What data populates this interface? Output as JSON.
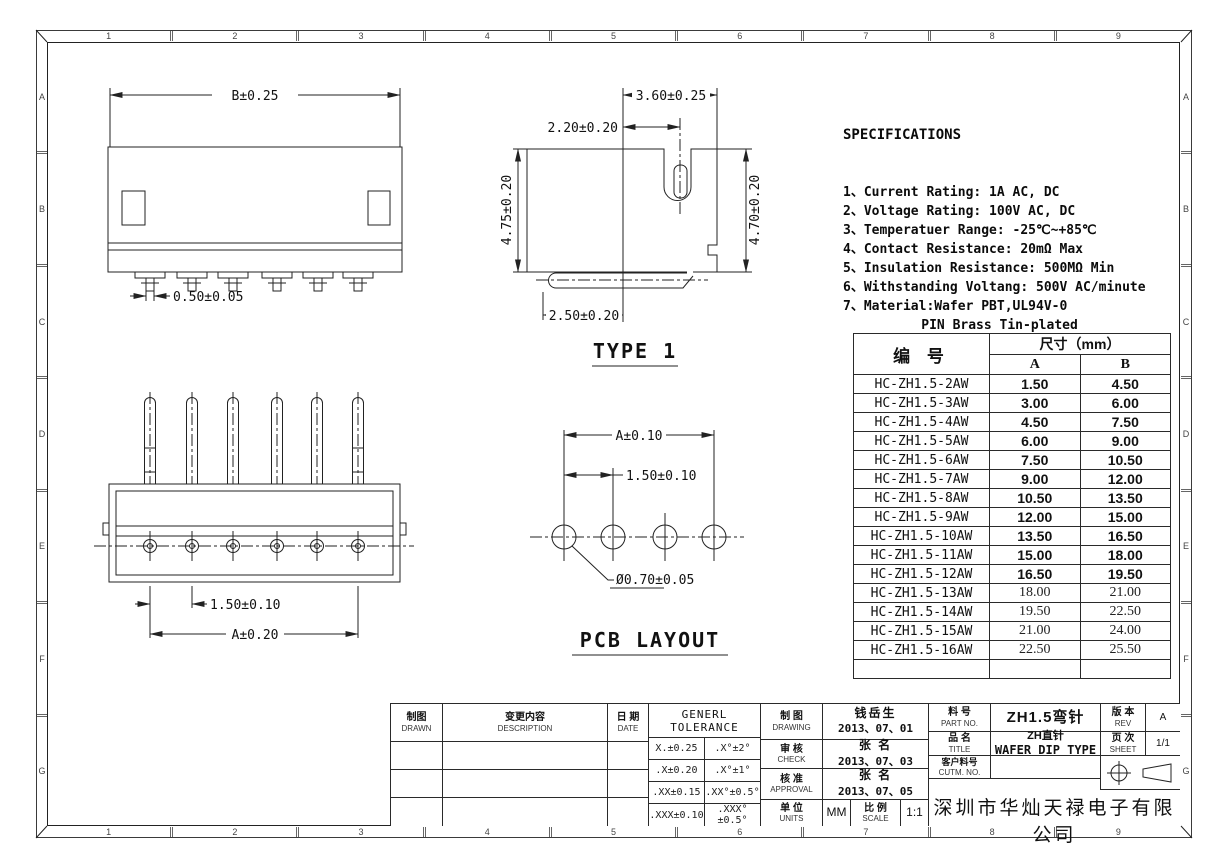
{
  "frame": {
    "columns": [
      "1",
      "2",
      "3",
      "4",
      "5",
      "6",
      "7",
      "8",
      "9"
    ],
    "rows": [
      "A",
      "B",
      "C",
      "D",
      "E",
      "F",
      "G"
    ]
  },
  "specs": {
    "title": "SPECIFICATIONS",
    "lines": [
      "1、Current Rating: 1A AC, DC",
      "2、Voltage Rating: 100V AC, DC",
      "3、Temperatuer Range: -25℃~+85℃",
      "4、Contact Resistance: 20mΩ Max",
      "5、Insulation Resistance: 500MΩ Min",
      "6、Withstanding Voltang: 500V AC/minute",
      "7、Material:Wafer PBT,UL94V-0",
      "          PIN Brass Tin-plated"
    ]
  },
  "views": {
    "side": {
      "dim_b": "B±0.25",
      "dim_pin": "0.50±0.05"
    },
    "type1": {
      "label": "TYPE 1",
      "dim_top": "3.60±0.25",
      "dim_slot": "2.20±0.20",
      "dim_left": "4.75±0.20",
      "dim_right": "4.70±0.20",
      "dim_bottom": "2.50±0.20"
    },
    "front": {
      "dim_pitch": "1.50±0.10",
      "dim_width": "A±0.20"
    },
    "pcb": {
      "label": "PCB LAYOUT",
      "dim_width": "A±0.10",
      "dim_pitch": "1.50±0.10",
      "dim_hole": "Ø0.70±0.05"
    }
  },
  "parts_table": {
    "col_part": "编  号",
    "col_dim": "尺寸（mm）",
    "col_a": "A",
    "col_b": "B",
    "rows": [
      {
        "part": "HC-ZH1.5-2AW",
        "a": "1.50",
        "b": "4.50",
        "bold": true
      },
      {
        "part": "HC-ZH1.5-3AW",
        "a": "3.00",
        "b": "6.00",
        "bold": true
      },
      {
        "part": "HC-ZH1.5-4AW",
        "a": "4.50",
        "b": "7.50",
        "bold": true
      },
      {
        "part": "HC-ZH1.5-5AW",
        "a": "6.00",
        "b": "9.00",
        "bold": true
      },
      {
        "part": "HC-ZH1.5-6AW",
        "a": "7.50",
        "b": "10.50",
        "bold": true
      },
      {
        "part": "HC-ZH1.5-7AW",
        "a": "9.00",
        "b": "12.00",
        "bold": true
      },
      {
        "part": "HC-ZH1.5-8AW",
        "a": "10.50",
        "b": "13.50",
        "bold": true
      },
      {
        "part": "HC-ZH1.5-9AW",
        "a": "12.00",
        "b": "15.00",
        "bold": true
      },
      {
        "part": "HC-ZH1.5-10AW",
        "a": "13.50",
        "b": "16.50",
        "bold": true
      },
      {
        "part": "HC-ZH1.5-11AW",
        "a": "15.00",
        "b": "18.00",
        "bold": true
      },
      {
        "part": "HC-ZH1.5-12AW",
        "a": "16.50",
        "b": "19.50",
        "bold": true
      },
      {
        "part": "HC-ZH1.5-13AW",
        "a": "18.00",
        "b": "21.00",
        "bold": false
      },
      {
        "part": "HC-ZH1.5-14AW",
        "a": "19.50",
        "b": "22.50",
        "bold": false
      },
      {
        "part": "HC-ZH1.5-15AW",
        "a": "21.00",
        "b": "24.00",
        "bold": false
      },
      {
        "part": "HC-ZH1.5-16AW",
        "a": "22.50",
        "b": "25.50",
        "bold": false
      },
      {
        "part": "",
        "a": "",
        "b": "",
        "bold": false
      }
    ]
  },
  "title_block": {
    "drawn": {
      "zh": "制图",
      "en": "DRAWN"
    },
    "description": {
      "zh": "变更内容",
      "en": "DESCRIPTION"
    },
    "date": {
      "zh": "日 期",
      "en": "DATE"
    },
    "tolerance": {
      "title": "GENERL TOLERANCE",
      "rows": [
        [
          "X.±0.25",
          ".X°±2°"
        ],
        [
          ".X±0.20",
          ".X°±1°"
        ],
        [
          ".XX±0.15",
          ".XX°±0.5°"
        ],
        [
          ".XXX±0.10",
          ".XXX°±0.5°"
        ]
      ]
    },
    "drawing": {
      "zh": "制 图",
      "en": "DRAWING",
      "name": "钱岳生",
      "date": "2013、07、01"
    },
    "check": {
      "zh": "审 核",
      "en": "CHECK",
      "name": "张  名",
      "date": "2013、07、03"
    },
    "approval": {
      "zh": "核 准",
      "en": "APPROVAL",
      "name": "张  名",
      "date": "2013、07、05"
    },
    "units": {
      "zh": "单 位",
      "en": "UNITS",
      "value": "MM"
    },
    "scale": {
      "zh": "比 例",
      "en": "SCALE",
      "value": "1:1"
    },
    "part_no": {
      "zh": "料 号",
      "en": "PART NO.",
      "value": "ZH1.5弯针"
    },
    "title": {
      "zh": "品 名",
      "en": "TITLE",
      "value_line1": "ZH直针",
      "value_line2": "WAFER DIP TYPE"
    },
    "customer": {
      "zh": "客户料号",
      "en": "CUTM. NO.",
      "value": ""
    },
    "rev": {
      "zh": "版 本",
      "en": "REV",
      "value": "A"
    },
    "sheet": {
      "zh": "页 次",
      "en": "SHEET",
      "value": "1/1"
    },
    "company": "深圳市华灿天禄电子有限公司"
  }
}
